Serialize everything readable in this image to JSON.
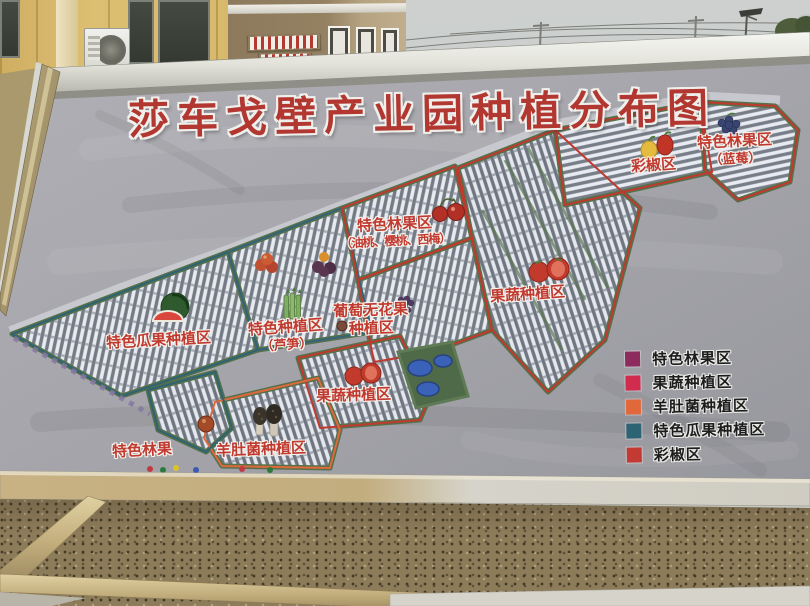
{
  "sign": {
    "title": "莎车戈壁产业园种植分布图"
  },
  "map": {
    "labels": {
      "melon": "特色瓜果种植区",
      "asparagus_1": "特色种植区",
      "asparagus_2": "（芦笋）",
      "stonefruit_1": "特色林果区",
      "stonefruit_2": "（油桃、樱桃、西梅）",
      "grape_1": "葡萄无花果",
      "grape_2": "种植区",
      "veg_right": "果蔬种植区",
      "pepper": "彩椒区",
      "blueberry_1": "特色林果区",
      "blueberry_2": "（蓝莓）",
      "veg_bottom": "果蔬种植区",
      "forest_fruit": "特色林果",
      "morel": "羊肚菌种植区"
    },
    "icons": [
      "watermelon-icon",
      "asparagus-icon",
      "nectarine-icon",
      "plum-icon",
      "cherry-icon",
      "grape-icon",
      "fig-icon",
      "tomato-icon",
      "bell-pepper-icon",
      "blueberry-icon",
      "morel-mushroom-icon",
      "apple-icon"
    ]
  },
  "legend": {
    "items": [
      {
        "label": "特色林果区",
        "color": "#8e2b5e"
      },
      {
        "label": "果蔬种植区",
        "color": "#d12b4d"
      },
      {
        "label": "羊肚菌种植区",
        "color": "#e0683a"
      },
      {
        "label": "特色瓜果种植区",
        "color": "#2e6374"
      },
      {
        "label": "彩椒区",
        "color": "#c33a32"
      }
    ]
  },
  "colors": {
    "title_red": "#b23731",
    "map_label_red": "#c13a30",
    "sign_fabric": "#a8a8ae",
    "sky": "#c7cac8"
  }
}
